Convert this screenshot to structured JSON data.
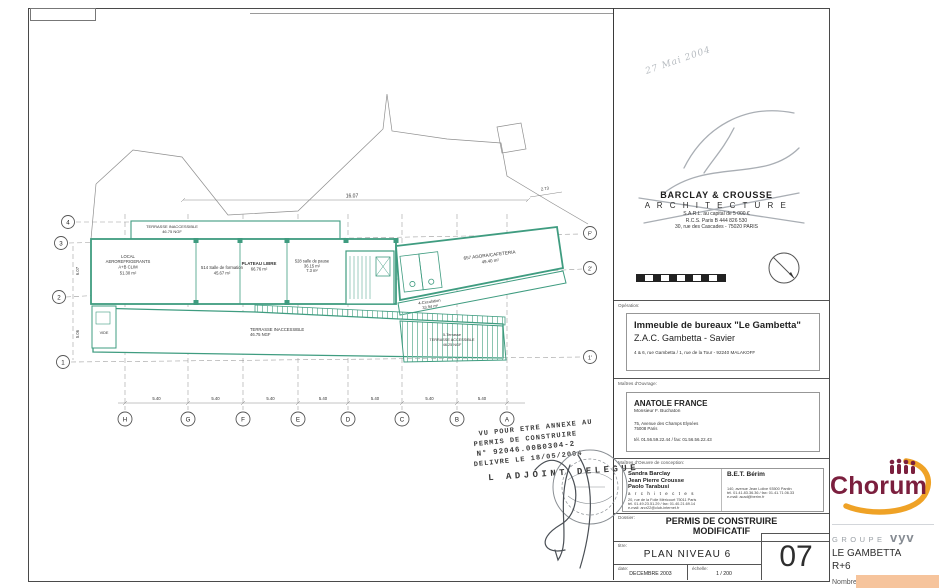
{
  "doc": {
    "handwritten_date": "27 Mai 2004",
    "architect": {
      "name": "BARCLAY & CROUSSE",
      "discipline": "A R C H I T E C T U R E",
      "legal": "S.A.R.L. au capital de 5 000 €",
      "rcs": "R.C.S.  Paris B 444 826 530",
      "address": "30, rue des Cascades - 75020 PARIS"
    },
    "operation": {
      "label": "Opération:",
      "title": "Immeuble de bureaux \"Le Gambetta\"",
      "subtitle": "Z.A.C.  Gambetta - Savier",
      "address": "4 & 6, rue Gambetta / 1, rue de la Tour    -    92240 MALAKOFF"
    },
    "owner": {
      "label": "Maîtres d'Ouvrage:",
      "name": "ANATOLE  FRANCE",
      "contact": "Monsieur  F. Buchaton",
      "address1": "75, Avenue des Champs Elysées",
      "address2": "75008 Paris",
      "phone": "tél. 01.56.59.22.44 / fax: 01.56.56.22.43"
    },
    "designers": {
      "label": "Maîtres d'Oeuvre de conception:",
      "arch_names": [
        "Sandra Barclay",
        "Jean Pierre Crousse",
        "Paolo Tarabusi"
      ],
      "arch_role": "a r c h i t e c t e s",
      "arch_address": "20, rue de la Folie Méricourt 75011 Paris",
      "arch_phone": "tél. 01.49.23.51.29 / fax: 01.40.21.69.14",
      "arch_email": "e-mail:  arcr22@club-internet.fr",
      "bet_name": "B.E.T.  Bérim",
      "bet_address": "140, avenue Jean Lolive   93500 Pantin",
      "bet_phone": "tél. 01.41.83.36.36 / fax: 01.41.71.06.33",
      "bet_email": "e-mail:  acad@berim.fr"
    },
    "dossier": {
      "label": "Dossier:",
      "line1": "PERMIS DE CONSTRUIRE",
      "line2": "MODIFICATIF"
    },
    "titre": {
      "label": "titre:",
      "value": "PLAN NIVEAU 6"
    },
    "number": "07",
    "date": {
      "label": "date:",
      "value": "DECEMBRE  2003"
    },
    "scale": {
      "label": "échelle:",
      "value": "1 / 200"
    }
  },
  "stamp": {
    "line1": "VU  POUR  ETRE  ANNEXE  AU",
    "line2": "PERMIS  DE  CONSTRUIRE",
    "line3": "N° 92046.00B0304-2",
    "line4": "DELIVRE  LE  18/05/2004",
    "signoff": "L ADJOINT  DELEGUE"
  },
  "branding": {
    "logo": "Chorum",
    "groupe": "GROUPE",
    "vyv": "vyv",
    "project": "LE GAMBETTA",
    "level": "R+6",
    "stat1": "Nombre de pièces: 11",
    "stat2": "Nombre d'affectations: 0",
    "stat3": "Surface qualifiée: 333.34 m²",
    "stat4": "by Surfy",
    "colors": {
      "maroon": "#7b1f3e",
      "orange": "#efa226",
      "gray": "#8d9298"
    }
  },
  "plan": {
    "colors": {
      "wall": "#3f9c80"
    },
    "rooms": {
      "local": {
        "lines": [
          "LOCAL",
          "AEROREFRIGERANTS",
          "A+B CLIM",
          "51.30 m²"
        ]
      },
      "vide": {
        "lines": [
          "VIDE"
        ]
      },
      "formation": {
        "lines": [
          "514 Salle de formation",
          "45.67 m²"
        ]
      },
      "plateau": {
        "lines": [
          "PLATEAU LIBRE",
          "66.76 m²"
        ]
      },
      "pause": {
        "lines": [
          "528 salle de pause",
          "36.15 m²",
          "7.3 m²"
        ]
      },
      "agora": {
        "lines": [
          "657 AGORA/CAFETERIA",
          "49.40 m²"
        ]
      },
      "circulation": {
        "lines": [
          "4-Circulation",
          "33.94 m²"
        ]
      },
      "terrasse_haut": {
        "lines": [
          "TERRASSE INACCESSIBLE",
          "46.75 NGF"
        ]
      },
      "terrasse_bas": {
        "lines": [
          "TERRASSE INACCESSIBLE",
          "46.75 NGF"
        ]
      },
      "terrasse_acc": {
        "lines": [
          "5-Terrasse",
          "TERRASSE ACCESSIBLE",
          "46.25 NGF"
        ]
      }
    },
    "grid": {
      "bottom": [
        "H",
        "G",
        "F",
        "E",
        "D",
        "C",
        "B",
        "A"
      ],
      "left": [
        "4",
        "3",
        "2",
        "1"
      ],
      "right": [
        "F'",
        "2'",
        "1'"
      ],
      "span": "5.40",
      "top_dim": "16.07",
      "top_dim_right": "2.73",
      "left_dim_top": "6.07",
      "left_dim_bottom": "5.06"
    }
  }
}
